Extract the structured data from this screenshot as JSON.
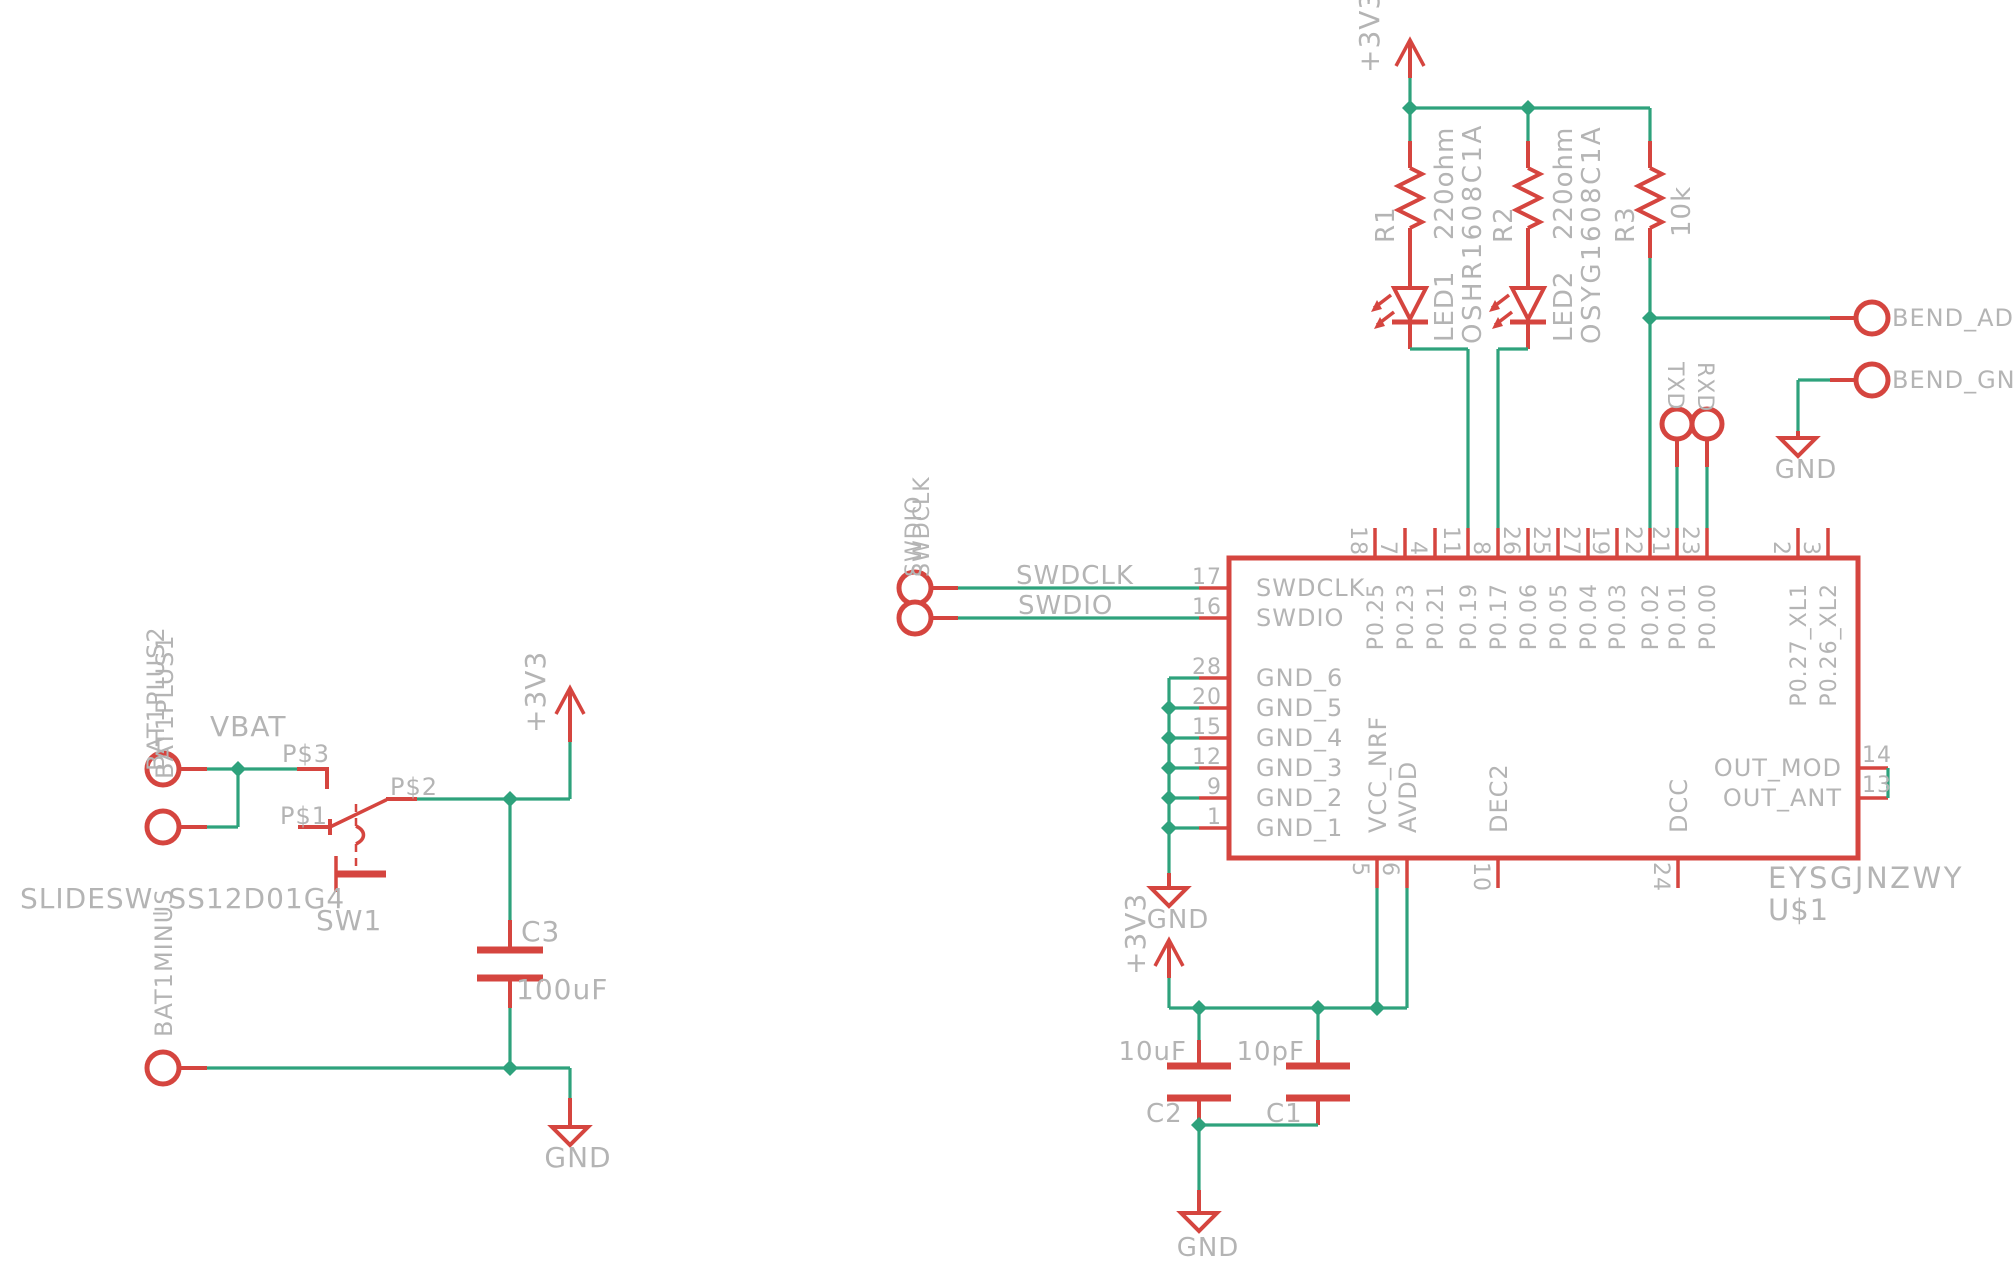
{
  "colors": {
    "wire": "#2EA27C",
    "symbol": "#D5453F",
    "label": "#B4B4B4",
    "background": "#FFFFFF"
  },
  "power": {
    "v33": "+3V3",
    "gnd": "GND"
  },
  "battery": {
    "vbat": "VBAT",
    "plus1": "BAT1PLUS1",
    "plus2": "BAT1PLUS2",
    "minus": "BAT1MINUS"
  },
  "switch1": {
    "name": "SW1",
    "value": "SLIDESW_SS12D01G4",
    "p1": "P$1",
    "p2": "P$2",
    "p3": "P$3"
  },
  "c3": {
    "name": "C3",
    "value": "100uF"
  },
  "c2": {
    "name": "C2",
    "value": "10uF"
  },
  "c1": {
    "name": "C1",
    "value": "10pF"
  },
  "r1": {
    "name": "R1",
    "value": "220ohm"
  },
  "r2": {
    "name": "R2",
    "value": "220ohm"
  },
  "r3": {
    "name": "R3",
    "value": "10k"
  },
  "led1": {
    "name": "LED1",
    "value": "OSHR1608C1A"
  },
  "led2": {
    "name": "LED2",
    "value": "OSYG1608C1A"
  },
  "uart": {
    "txd": "TXD",
    "rxd": "RXD"
  },
  "bend": {
    "adc": "BEND_ADC",
    "gnd": "BEND_GND"
  },
  "swd": {
    "clk": "SWDCLK",
    "dio": "SWDIO"
  },
  "ic": {
    "name": "U$1",
    "value": "EYSGJNZWY",
    "top": [
      {
        "n": "18",
        "p": "P0.25"
      },
      {
        "n": "7",
        "p": "P0.23"
      },
      {
        "n": "4",
        "p": "P0.21"
      },
      {
        "n": "11",
        "p": "P0.19"
      },
      {
        "n": "8",
        "p": "P0.17"
      },
      {
        "n": "26",
        "p": "P0.06"
      },
      {
        "n": "25",
        "p": "P0.05"
      },
      {
        "n": "27",
        "p": "P0.04"
      },
      {
        "n": "19",
        "p": "P0.03"
      },
      {
        "n": "22",
        "p": "P0.02"
      },
      {
        "n": "21",
        "p": "P0.01"
      },
      {
        "n": "23",
        "p": "P0.00"
      },
      {
        "n": "2",
        "p": "P0.27_XL1"
      },
      {
        "n": "3",
        "p": "P0.26_XL2"
      }
    ],
    "left": [
      {
        "n": "17",
        "p": "SWDCLK"
      },
      {
        "n": "16",
        "p": "SWDIO"
      },
      {
        "n": "28",
        "p": "GND_6"
      },
      {
        "n": "20",
        "p": "GND_5"
      },
      {
        "n": "15",
        "p": "GND_4"
      },
      {
        "n": "12",
        "p": "GND_3"
      },
      {
        "n": "9",
        "p": "GND_2"
      },
      {
        "n": "1",
        "p": "GND_1"
      }
    ],
    "bottom": [
      {
        "n": "5",
        "p": "VCC_NRF"
      },
      {
        "n": "6",
        "p": "AVDD"
      },
      {
        "n": "10",
        "p": "DEC2"
      },
      {
        "n": "24",
        "p": "DCC"
      }
    ],
    "right": [
      {
        "n": "14",
        "p": "OUT_MOD"
      },
      {
        "n": "13",
        "p": "OUT_ANT"
      }
    ]
  }
}
